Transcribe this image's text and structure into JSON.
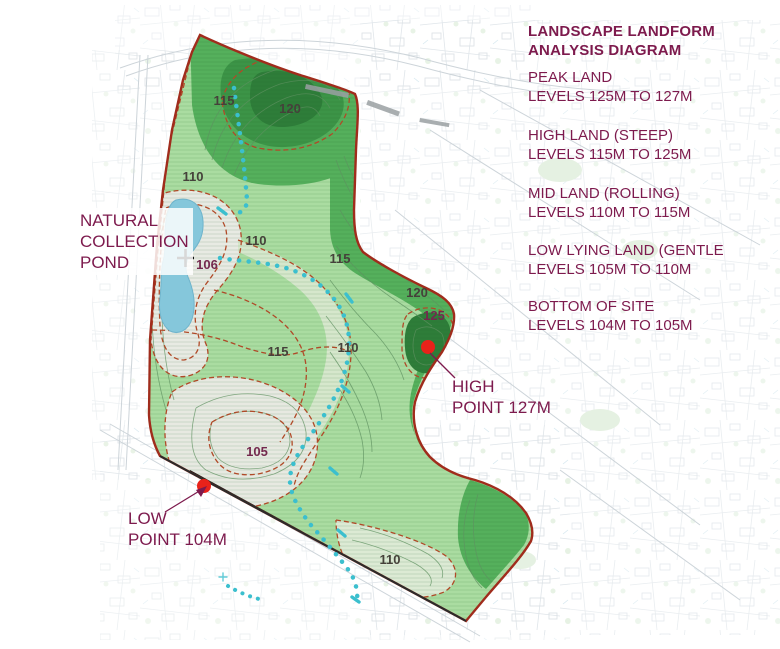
{
  "title": "LANDSCAPE LANDFORM\nANALYSIS DIAGRAM",
  "legend": {
    "items": [
      {
        "name": "PEAK LAND",
        "levels": "LEVELS 125M TO 127M"
      },
      {
        "name": "HIGH LAND (STEEP)",
        "levels": "LEVELS 115M TO 125M"
      },
      {
        "name": "MID LAND (ROLLING)",
        "levels": "LEVELS 110M TO 115M"
      },
      {
        "name": "LOW LYING LAND (GENTLE",
        "levels": "LEVELS 105M TO 110M"
      },
      {
        "name": "BOTTOM OF SITE",
        "levels": "LEVELS 104M TO 105M"
      }
    ]
  },
  "annotations": {
    "pond": "NATURAL\nCOLLECTION\nPOND",
    "high_point": "HIGH\nPOINT 127M",
    "low_point": "LOW\nPOINT 104M"
  },
  "contour_labels": [
    "115",
    "120",
    "110",
    "110",
    "115",
    "106",
    "115",
    "110",
    "120",
    "125",
    "105",
    "110"
  ],
  "markers": {
    "high_point_spot": "red-diamond 127m",
    "low_point_spot": "red-diamond 104m",
    "pond_spot": "cross 106m"
  },
  "colors": {
    "text_maroon": "#7d1a4d",
    "site_boundary_red": "#a02c1c",
    "contour_dash_red": "#b04a28",
    "peak_dark_green": "#2e7d39",
    "high_green": "#55b05c",
    "mid_green": "#8ccd86",
    "light_green": "#aadca1",
    "pale_bowl": "#e8eae3",
    "pond_blue": "#85c7db",
    "drainage_teal": "#3bbfce",
    "marker_red": "#e8221a"
  }
}
